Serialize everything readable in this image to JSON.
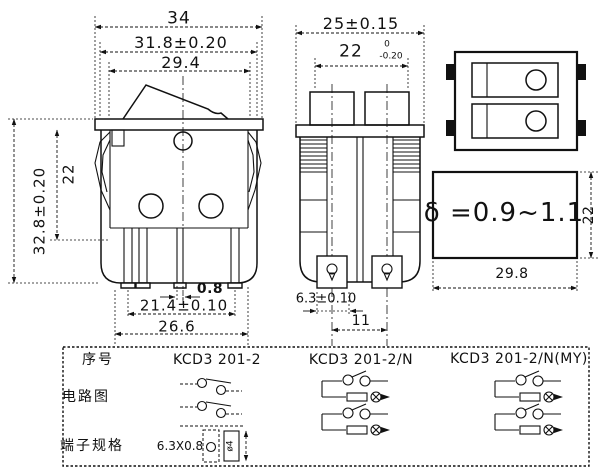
{
  "colors": {
    "ink": "#111111",
    "paper": "#ffffff"
  },
  "labels": {
    "d34": "34",
    "d318": "31.8±0.20",
    "d294": "29.4",
    "d328": "32.8±0.20",
    "d22_left": "22",
    "d08": "0.8",
    "d214": "21.4±0.10",
    "d266": "26.6",
    "d25": "25±0.15",
    "d22_mid": "22",
    "d22_tol_top": "0",
    "d22_tol_bottom": "-0.20",
    "d63": "6.3±0.10",
    "d11": "11",
    "delta": "δ =0.9~1.1",
    "d22_cutout": "22",
    "d298": "29.8",
    "hole_dim": "ø4"
  },
  "table": {
    "row_no": "序号",
    "row_circuit": "电路图",
    "row_terminal": "端子规格",
    "model_1": "KCD3 201-2",
    "model_2": "KCD3 201-2/N",
    "model_3": "KCD3 201-2/N(MY)",
    "terminal_spec": "6.3X0.8"
  }
}
